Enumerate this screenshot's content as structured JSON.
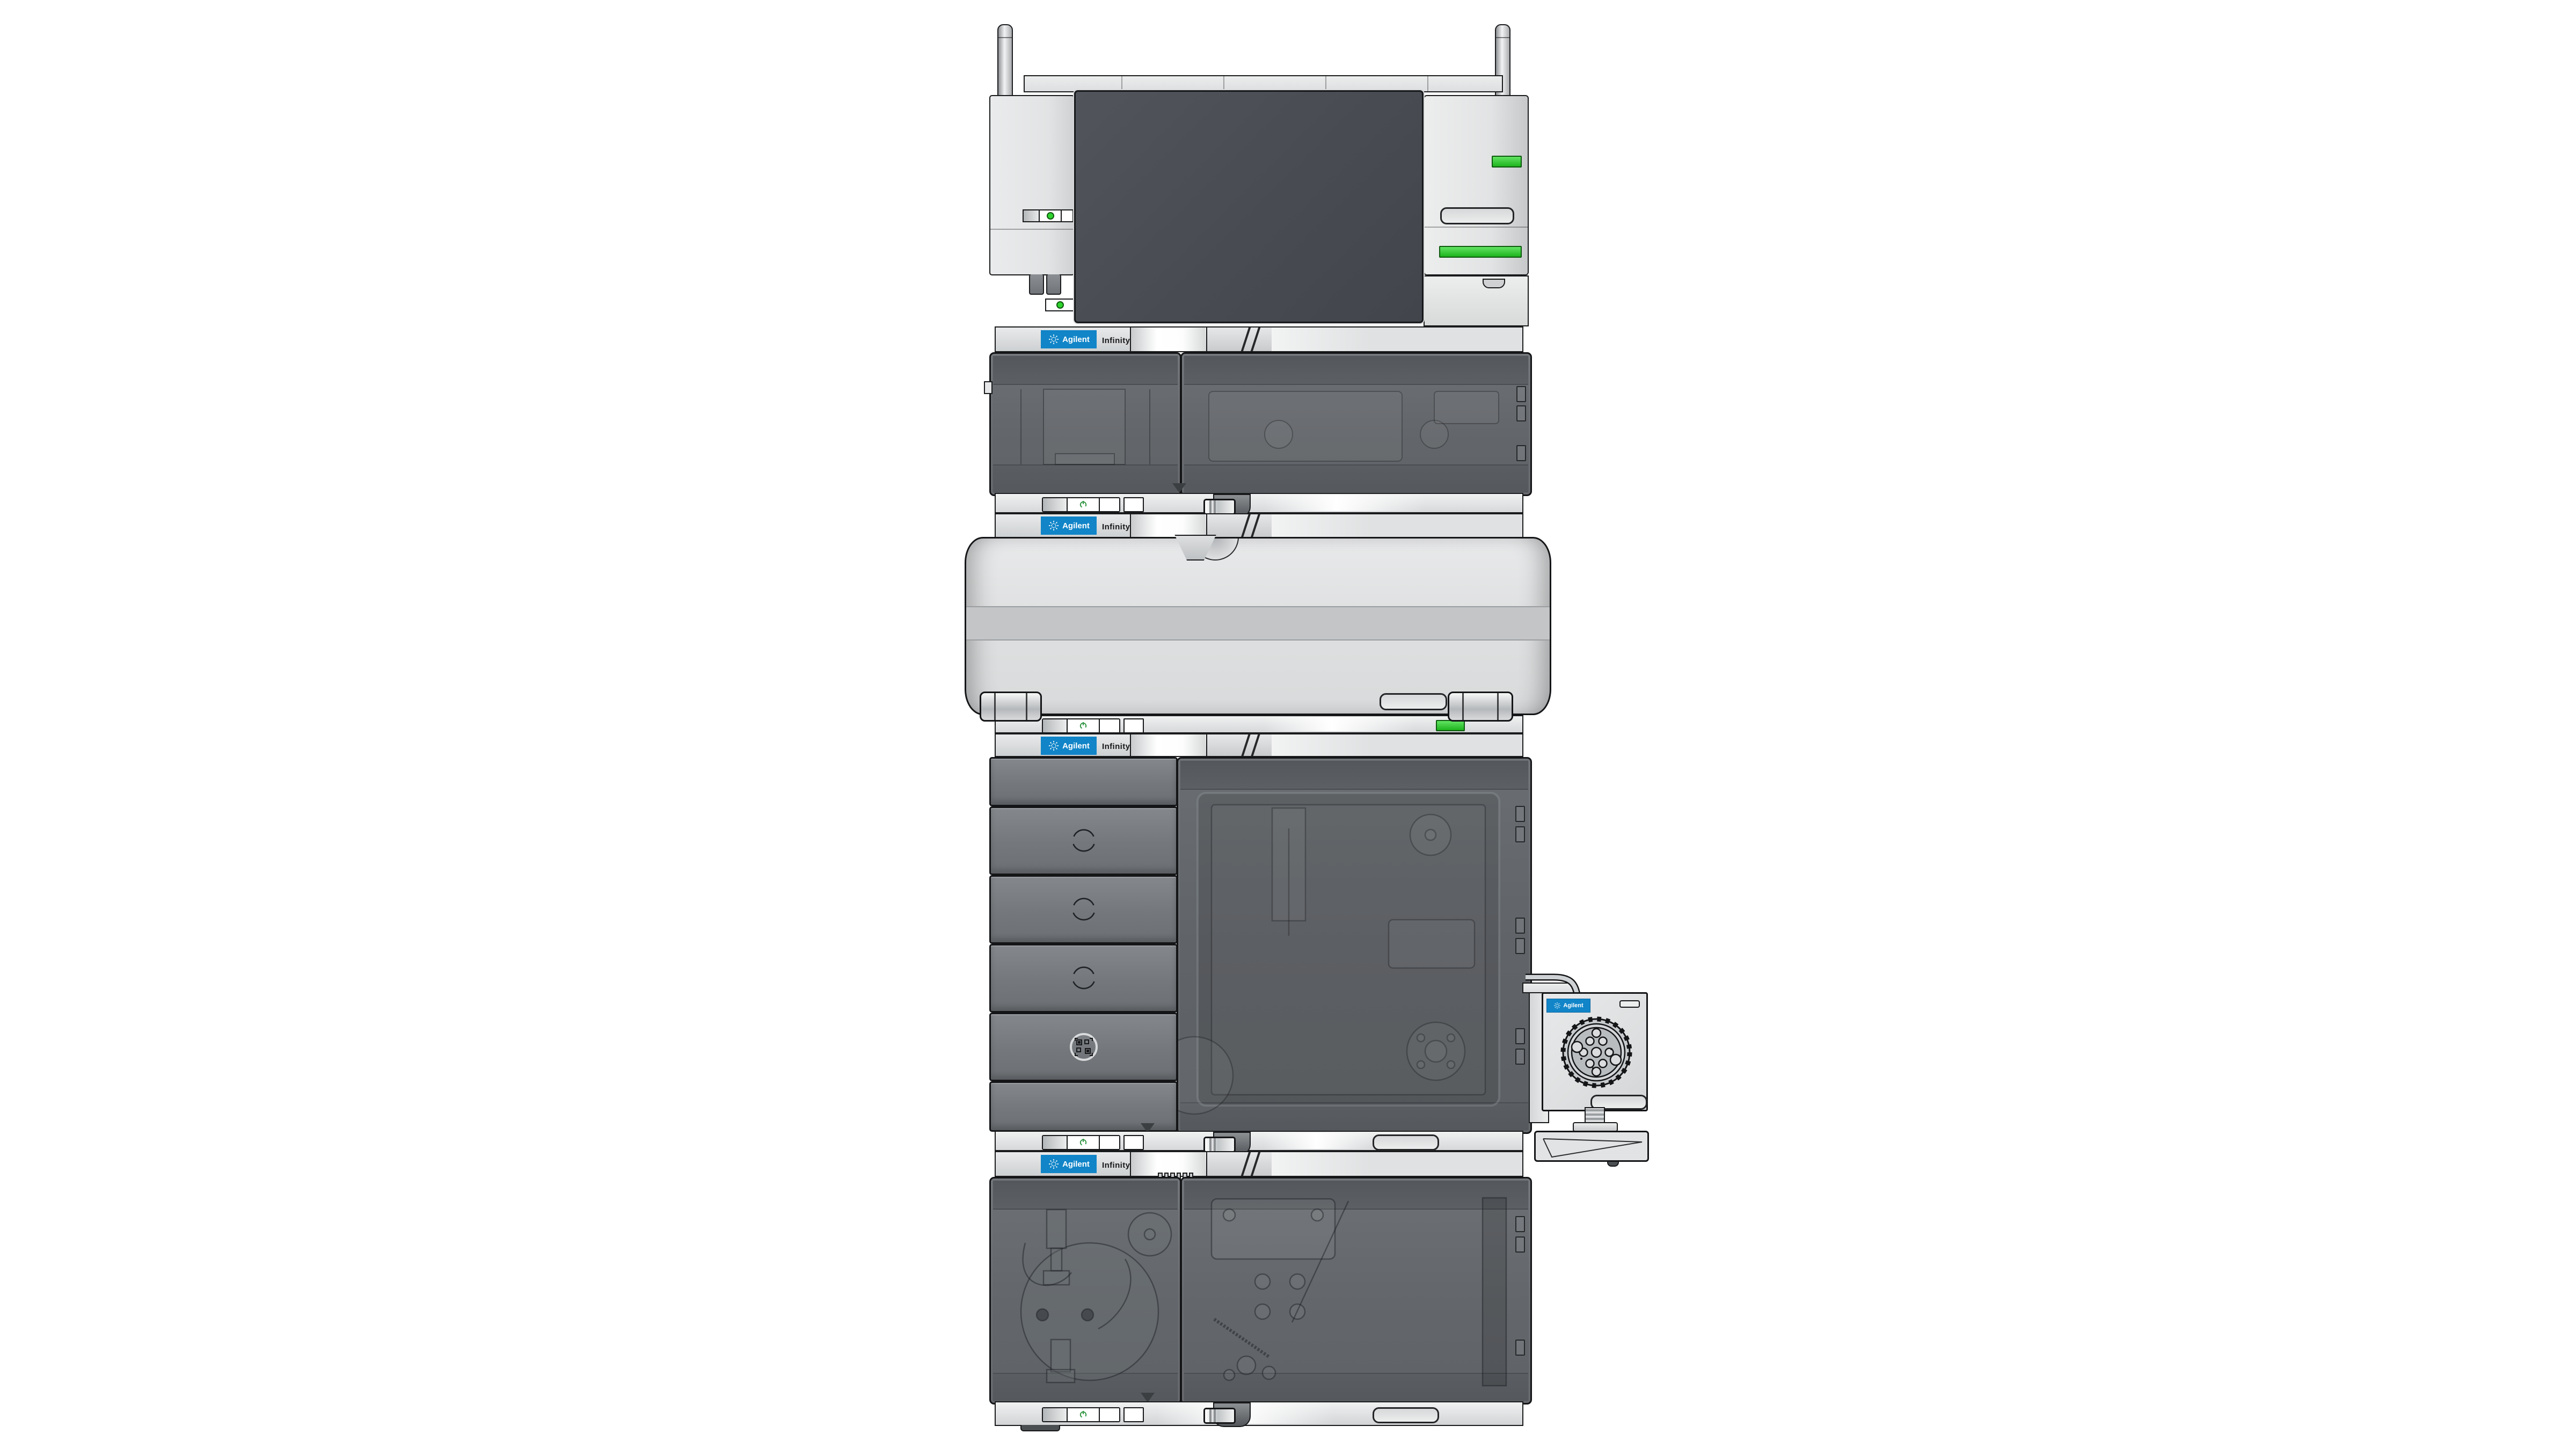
{
  "branding": {
    "brand": "Agilent",
    "series": "Infinity III",
    "logo_icon": "agilent-starburst-icon"
  },
  "colors": {
    "agilent_blue": "#1185c8",
    "led_green": "#2fd42f",
    "power_glyph_green": "#2e9440",
    "module_dark_gray": "#66696d",
    "drawer_gray": "#777b7f",
    "screen_dark_gray": "#4b4f55",
    "panel_light_gray": "#e4e5e6",
    "outline_black": "#1a1b1c",
    "background_white": "#ffffff"
  },
  "stack": {
    "module_header_strips": [
      {
        "brand": "Agilent",
        "series": "Infinity III"
      },
      {
        "brand": "Agilent",
        "series": "Infinity III"
      },
      {
        "brand": "Agilent",
        "series": "Infinity III"
      },
      {
        "brand": "Agilent",
        "series": "Infinity III"
      }
    ],
    "side_module": {
      "brand": "Agilent"
    }
  },
  "icons": {
    "power": "power-icon",
    "starburst": "agilent-starburst-icon",
    "drawer_ring": "drawer-pull-ring-icon",
    "qr": "qr-code-icon",
    "valve_wheel": "valve-wheel-icon"
  }
}
